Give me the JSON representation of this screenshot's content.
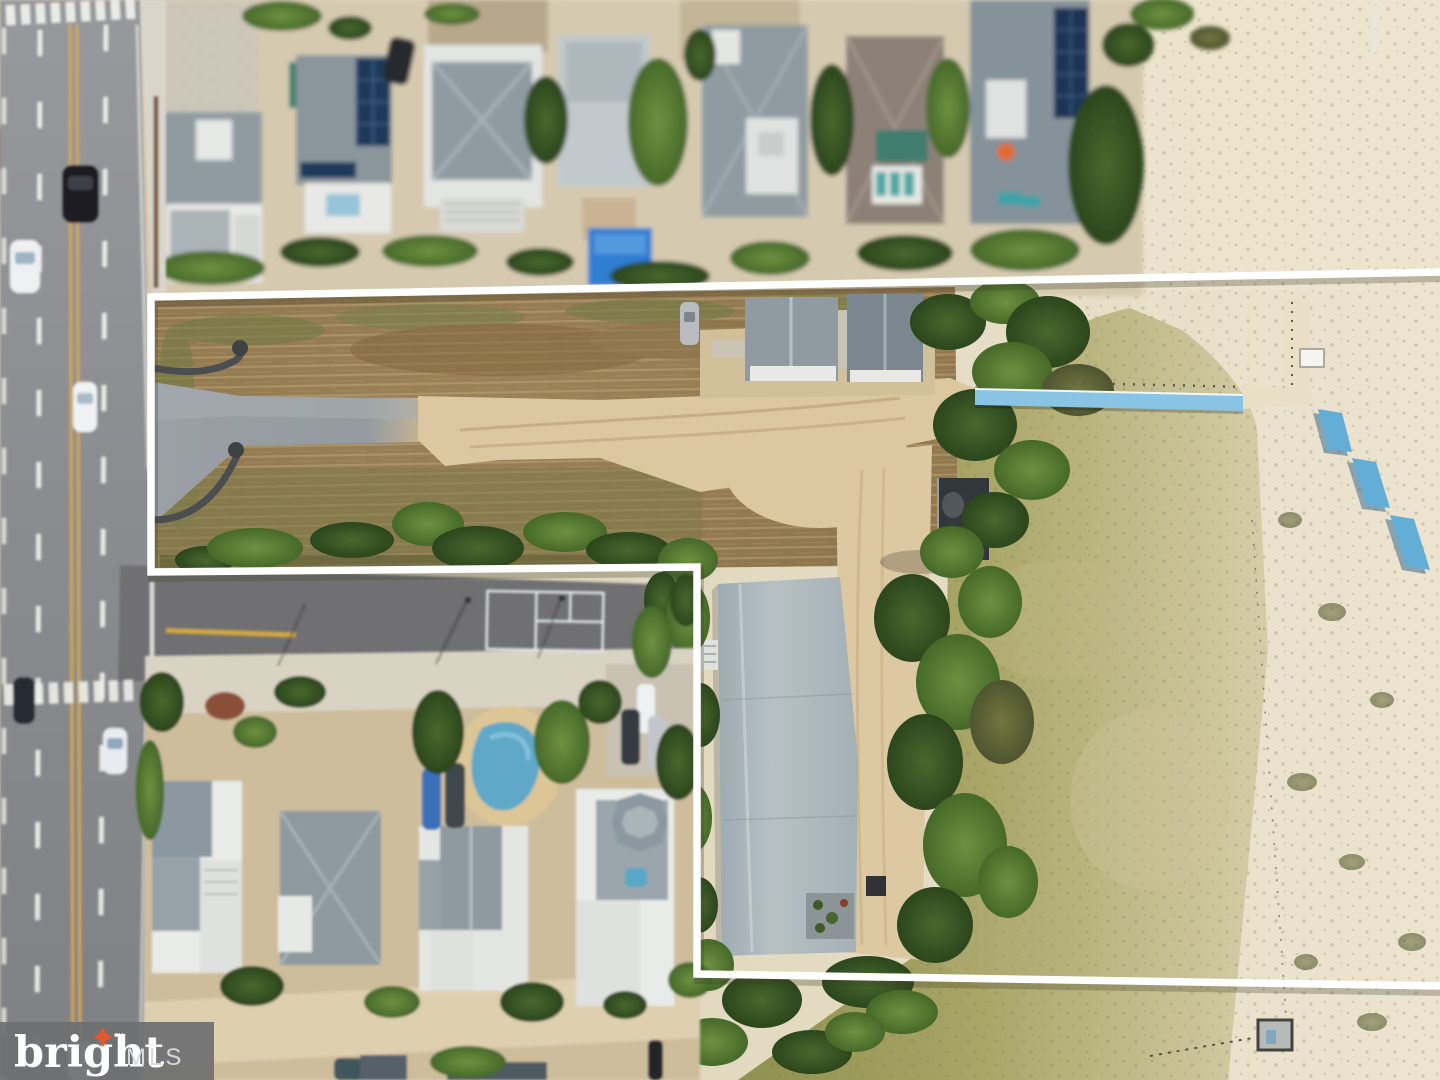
{
  "image": {
    "description": "Aerial drone photo of a vacant beach-block land parcel outlined in white, bordered by a highway on the left, residential houses above and below, and grassy sand dunes with a blue beach boardwalk on the right",
    "width_px": 1440,
    "height_px": 1080
  },
  "watermark": {
    "brand": "bright",
    "trademark": "™",
    "suffix": "MLS",
    "background": "#6e6f71",
    "brand_color": "#ffffff",
    "suffix_color": "#d8d9da",
    "star_color": "#e2572b"
  },
  "colors": {
    "boundary": "#ffffff",
    "boundary_shadow": "rgba(60,60,40,0.28)",
    "boardwalk_blue": "#8ac4e4",
    "beach_mat_blue": "#63aed6",
    "pool_tarp_blue": "#2e7ed2",
    "pool_water": "#5fa8c8",
    "hot_tub": "#58a8c8",
    "green_pool": "#3f7d6e",
    "center_line_yellow": "#d2a844",
    "court_line": "#e3e6e8",
    "umbrella_orange": "#e06a35"
  }
}
